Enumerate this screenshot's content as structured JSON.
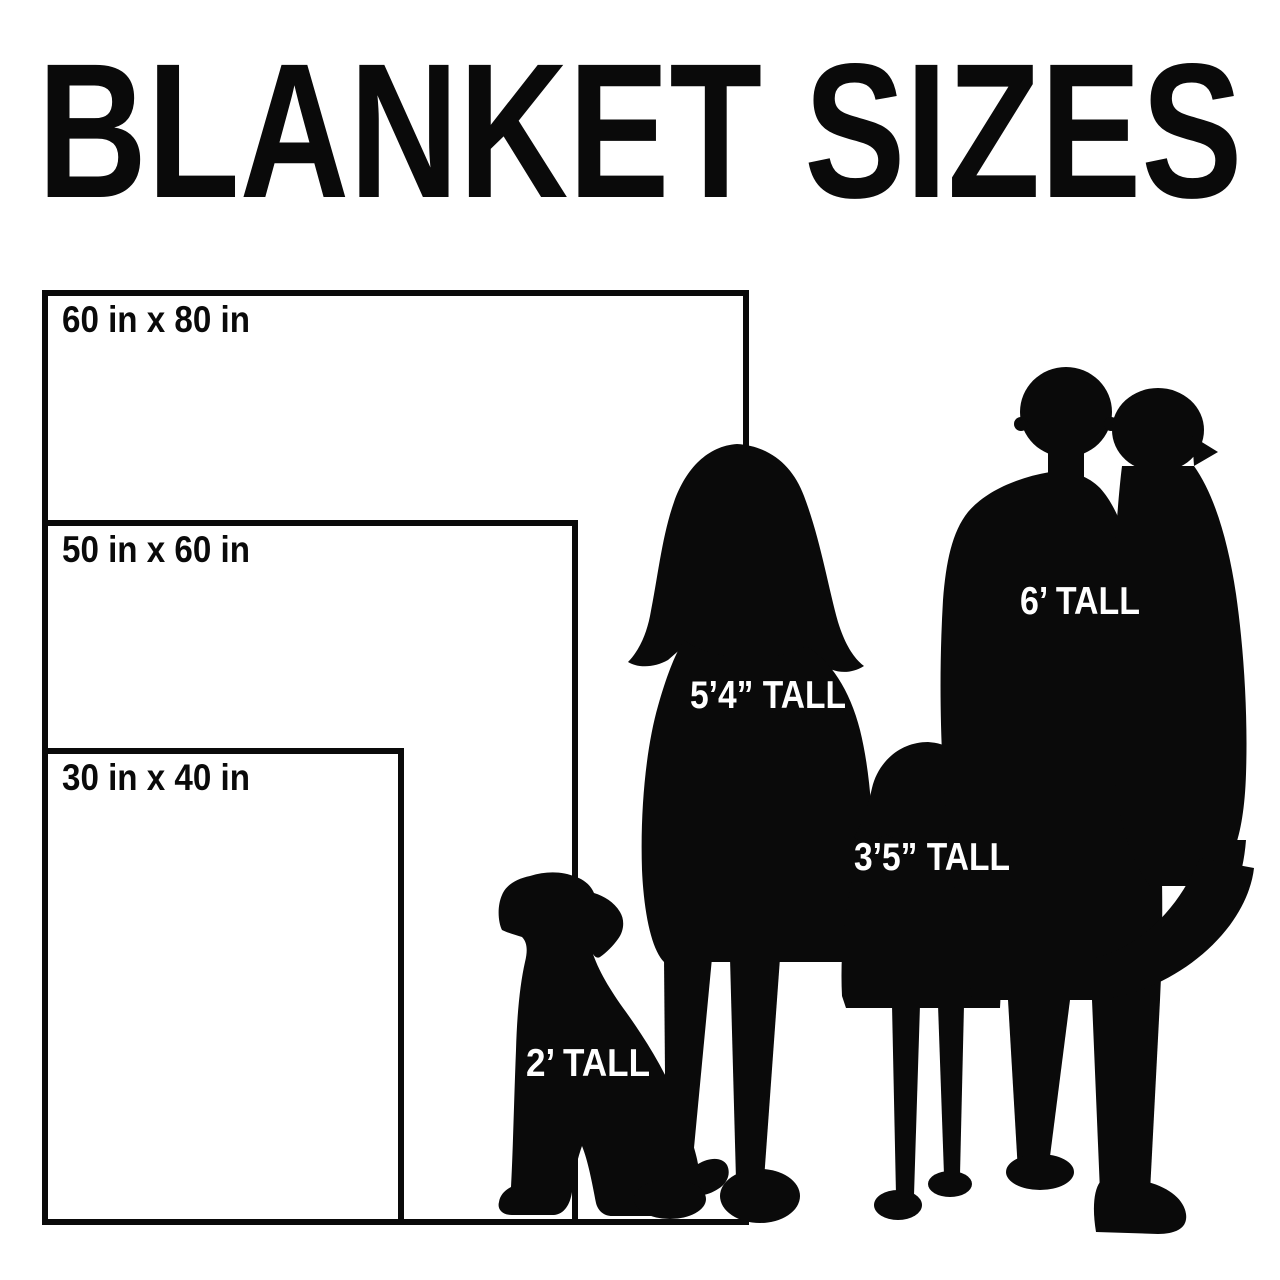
{
  "title": "BLANKET SIZES",
  "colors": {
    "ink": "#0a0a0a",
    "background": "#ffffff",
    "label_on_silhouette": "#ffffff"
  },
  "blankets": [
    {
      "label": "60 in x 80 in",
      "width_in": 60,
      "height_in": 80
    },
    {
      "label": "50 in x 60 in",
      "width_in": 50,
      "height_in": 60
    },
    {
      "label": "30 in x 40 in",
      "width_in": 30,
      "height_in": 40
    }
  ],
  "figures": [
    {
      "name": "dog",
      "label": "2’ TALL"
    },
    {
      "name": "woman",
      "label": "5’4” TALL"
    },
    {
      "name": "girl",
      "label": "3’5” TALL"
    },
    {
      "name": "man",
      "label": "6’ TALL"
    }
  ]
}
